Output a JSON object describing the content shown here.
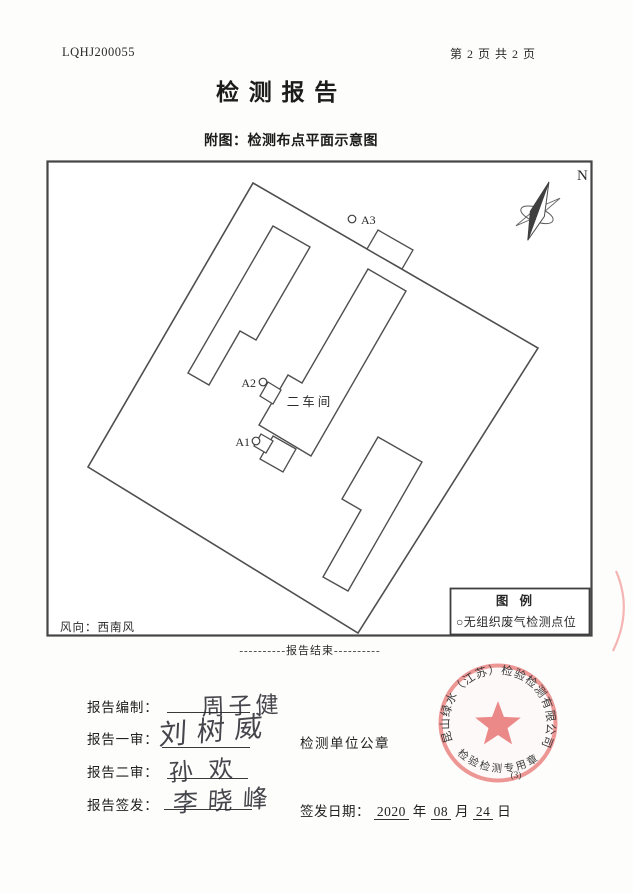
{
  "header": {
    "report_no": "LQHJ200055",
    "page_info": "第 2 页 共 2 页",
    "title": "检 测 报 告",
    "subtitle": "附图：检测布点平面示意图"
  },
  "diagram": {
    "north_label": "N",
    "workshop_label": "二车间",
    "points": [
      {
        "id": "A1"
      },
      {
        "id": "A2"
      },
      {
        "id": "A3"
      }
    ],
    "legend": {
      "title": "图  例",
      "item": "○无组织废气检测点位"
    },
    "wind_label": "风向：西南风",
    "end_line": "----------报告结束----------"
  },
  "footer": {
    "rows": [
      {
        "label": "报告编制：",
        "signature": "周子健"
      },
      {
        "label": "报告一审：",
        "signature": "刘树威"
      },
      {
        "label": "报告二审：",
        "signature": "孙欢"
      },
      {
        "label": "报告签发：",
        "signature": "李晓峰"
      }
    ],
    "seal_caption": "检测单位公章",
    "issue_date": {
      "label": "签发日期：",
      "year": "2020",
      "year_unit": "年",
      "month": "08",
      "month_unit": "月",
      "day": "24",
      "day_unit": "日"
    },
    "seal": {
      "company": "昆山绿水（江苏）检验检测有限公司",
      "type_text": "检验检测专用章",
      "number": "(3)",
      "color": "#e5716f"
    }
  }
}
